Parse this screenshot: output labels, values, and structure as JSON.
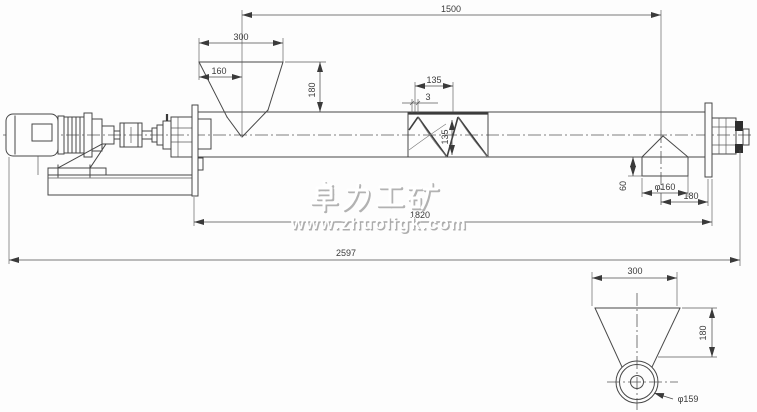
{
  "watermark": {
    "brand": "卓力工矿",
    "url": "www.zhuoligk.com"
  },
  "colors": {
    "line": "#474747",
    "background": "#fdfdfd",
    "watermark_shadow": "#a6a6a6",
    "watermark_face": "#ffffff"
  },
  "dimensions": {
    "main_view": {
      "inlet_to_outlet_center": "1500",
      "hopper_top_width": "300",
      "hopper_left_to_center": "160",
      "hopper_height": "180",
      "screw_pitch": "135",
      "flight_thickness": "3",
      "screw_diameter": "135",
      "outlet_stub_height": "60",
      "outlet_diameter": "φ160",
      "outlet_center_to_flange": "180",
      "trough_length": "1820",
      "overall_length": "2597"
    },
    "detail_view": {
      "hopper_top_width": "300",
      "hopper_depth": "180",
      "pipe_diameter": "φ159"
    }
  }
}
